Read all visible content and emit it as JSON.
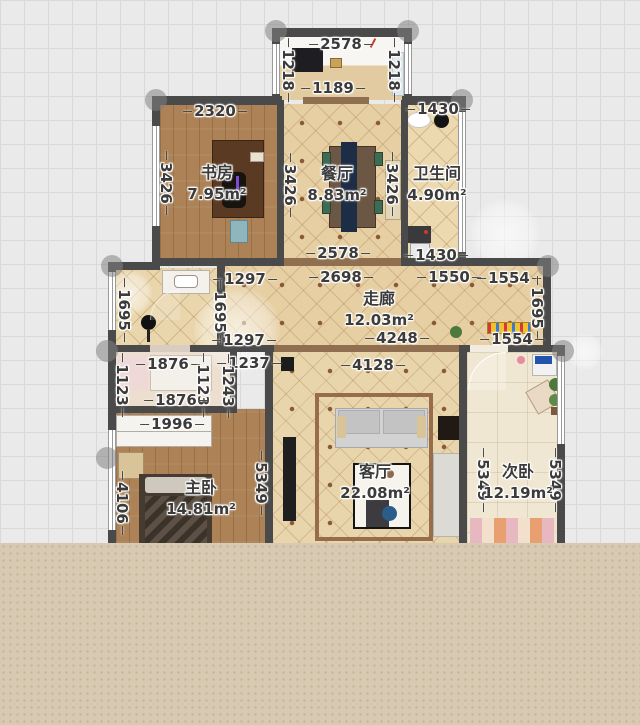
{
  "app": {
    "view": "floorplan-editor"
  },
  "colors": {
    "grid_bg": "#eaeaea",
    "grid_line": "#d9d9d9",
    "wall": "#4a4a4a",
    "threshold": "#8f6f4f",
    "tile": "#e6cfa3",
    "wood": "#ac8256",
    "marble": "#f0e7d3",
    "bottom_band": "#d8cab2",
    "accent_shelf": "#f0c030"
  },
  "rooms": [
    {
      "name": "书房",
      "area": "7.95m²"
    },
    {
      "name": "餐厅",
      "area": "8.83m²"
    },
    {
      "name": "卫生间",
      "area": "4.90m²"
    },
    {
      "name": "走廊",
      "area": "12.03m²"
    },
    {
      "name": "主卧",
      "area": "14.81m²"
    },
    {
      "name": "客厅",
      "area": "22.08m²"
    },
    {
      "name": "次卧",
      "area": "12.19m²"
    }
  ],
  "dims": {
    "balcony_top": "2578",
    "balcony_left": "1218",
    "balcony_right": "1218",
    "balcony_opening": "1189",
    "study_top": "2320",
    "study_left": "3426",
    "study_right": "3426",
    "dining_right": "3426",
    "bath_top": "1430",
    "bath_bottom": "1430",
    "dining_bottom": "2578",
    "corridor_top_left": "2698",
    "corridor_top_mid": "1550",
    "corridor_top_right": "1554",
    "foyer_top": "1297",
    "foyer_bottom": "1297",
    "foyer_left": "1695",
    "foyer_right": "1695",
    "corridor_right": "1695",
    "corridor_bottom": "4248",
    "corridor_bottom_right": "1554",
    "closet_top": "1876",
    "closet_top_right": "1237",
    "closet_left": "1123",
    "closet_mid": "1123",
    "closet_right": "1243",
    "closet_second": "1876",
    "wardrobe": "1996",
    "living_top": "4128",
    "master_left": "4106",
    "master_right": "5349",
    "second_left": "5349",
    "second_right": "5349"
  }
}
